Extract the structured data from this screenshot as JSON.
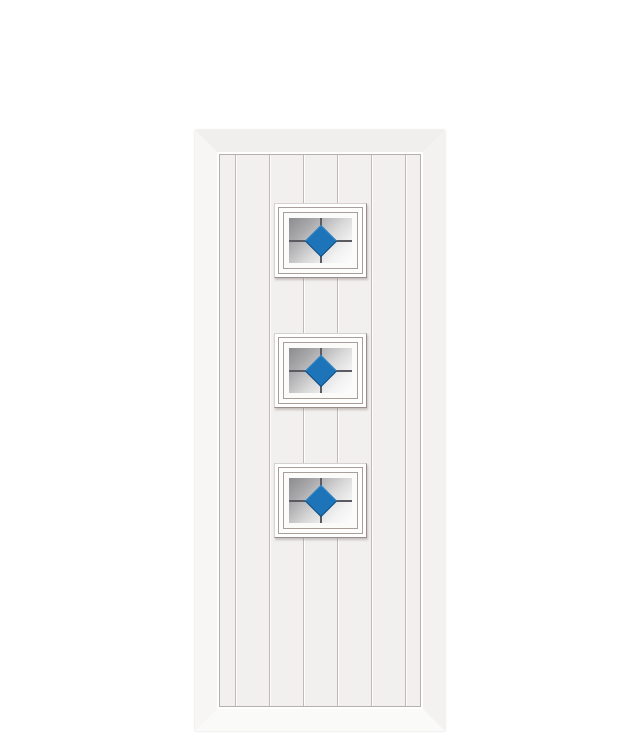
{
  "meta": {
    "description": "Product render of a white cottage-style composite door with a vertically grooved plank face and three square glazed panels, each containing grey-gradient obscure glass, a dark leaded cross and a central blue diamond.",
    "visible_text": ""
  },
  "theme": {
    "background": "#ffffff",
    "frame-top": "#f1efee",
    "frame-left": "#f8f6f5",
    "frame-right": "#f4f2f1",
    "frame-bottom": "#fafaf9",
    "frame-highlight": "#ffffff",
    "panel": "#f2f0ee",
    "panel-line": "#b6afac",
    "groove-dark": "#c0b9b5",
    "groove-light": "#fdfdfd",
    "win-frame": "#ffffff",
    "win-edge-light": "#d6d2d0",
    "win-edge-dark": "#9a908b",
    "moulding-line": "#a89f9b",
    "glass-dark": "#8c8c8e",
    "glass-mid": "#d9d9da",
    "glass-light": "#fdfdfd",
    "lead": "#5b5b61",
    "diamond": "#1e74b8",
    "diamond-edge": "#0f4d80"
  },
  "door": {
    "style": "white-cottage-door-three-glazed-squares",
    "plank_groove_count": 6,
    "groove_offsets_px": [
      15,
      49,
      83,
      117,
      151,
      185
    ],
    "window_count": 3,
    "window_tops_px": [
      48,
      178,
      308
    ],
    "window_size_px": {
      "width": 93,
      "height": 75
    },
    "diamond_size_px": 23
  }
}
